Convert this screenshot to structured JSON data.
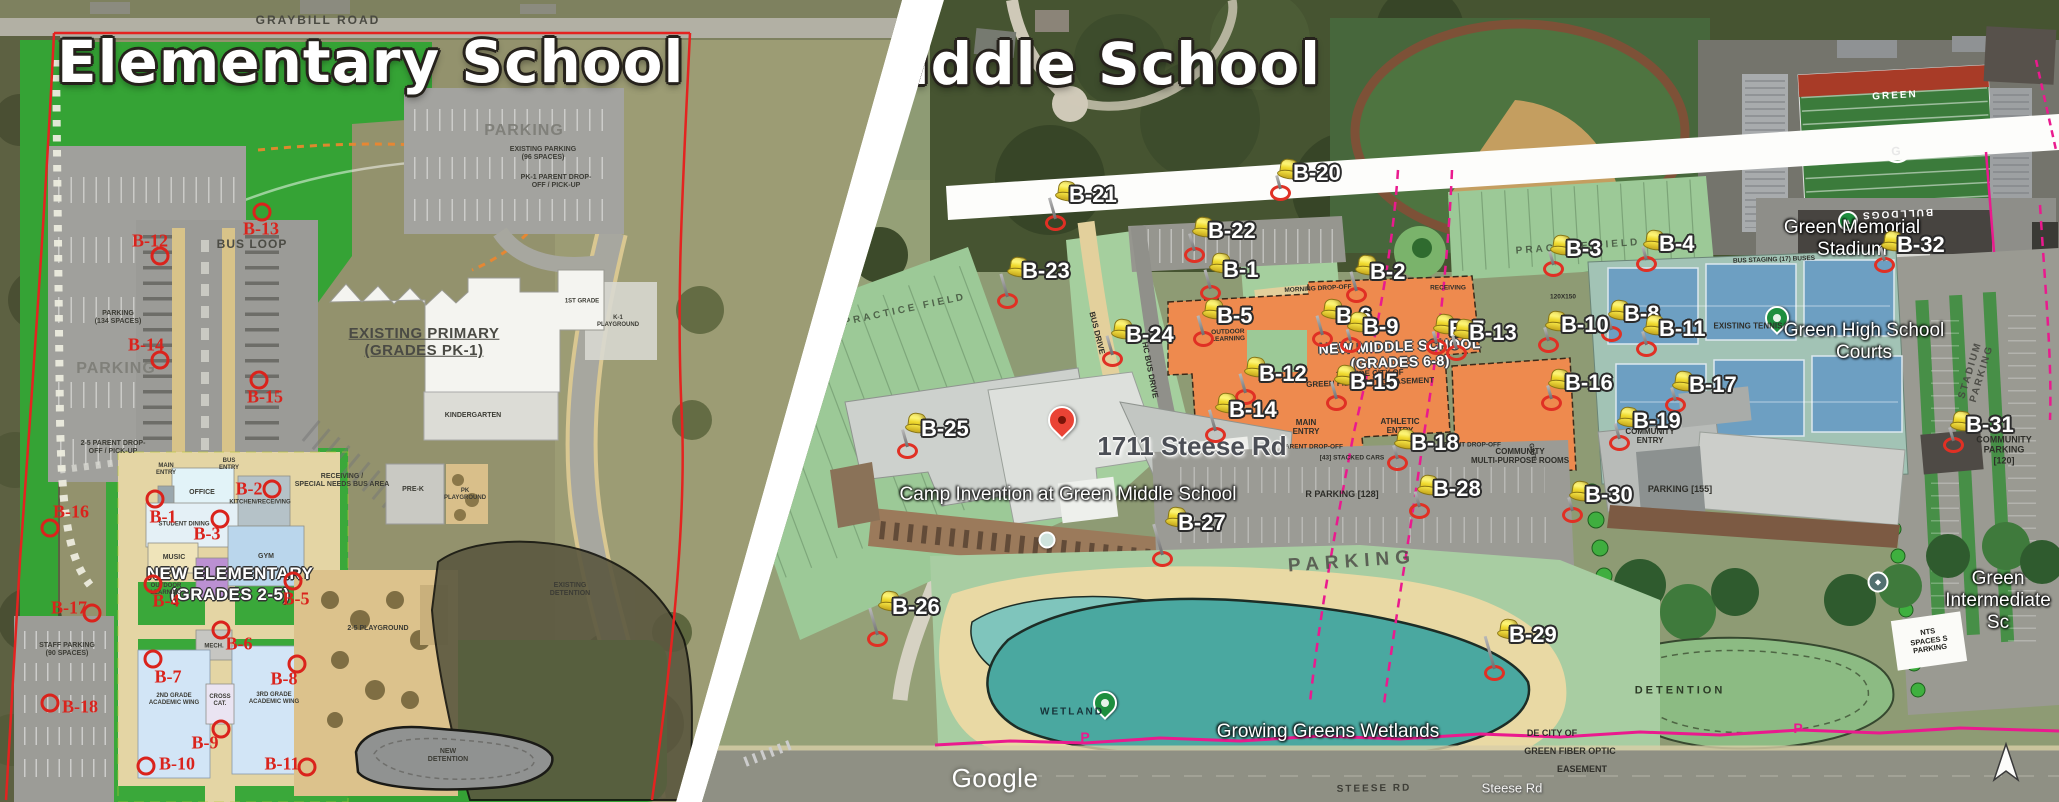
{
  "watermark": "Google",
  "left_panel": {
    "title": "Elementary School",
    "markers": [
      {
        "id": "B-1",
        "cx": 155,
        "cy": 499,
        "lx": 163,
        "ly": 517
      },
      {
        "id": "B-2",
        "cx": 272,
        "cy": 489,
        "lx": 249,
        "ly": 489
      },
      {
        "id": "B-3",
        "cx": 220,
        "cy": 519,
        "lx": 207,
        "ly": 534
      },
      {
        "id": "B-4",
        "cx": 153,
        "cy": 584,
        "lx": 166,
        "ly": 601
      },
      {
        "id": "B-5",
        "cx": 293,
        "cy": 581,
        "lx": 296,
        "ly": 599
      },
      {
        "id": "B-6",
        "cx": 221,
        "cy": 630,
        "lx": 239,
        "ly": 644
      },
      {
        "id": "B-7",
        "cx": 153,
        "cy": 659,
        "lx": 168,
        "ly": 677
      },
      {
        "id": "B-8",
        "cx": 297,
        "cy": 664,
        "lx": 284,
        "ly": 679
      },
      {
        "id": "B-9",
        "cx": 221,
        "cy": 729,
        "lx": 205,
        "ly": 743
      },
      {
        "id": "B-10",
        "cx": 146,
        "cy": 766,
        "lx": 177,
        "ly": 764
      },
      {
        "id": "B-11",
        "cx": 307,
        "cy": 767,
        "lx": 282,
        "ly": 764
      },
      {
        "id": "B-12",
        "cx": 160,
        "cy": 256,
        "lx": 150,
        "ly": 241
      },
      {
        "id": "B-13",
        "cx": 262,
        "cy": 212,
        "lx": 261,
        "ly": 229
      },
      {
        "id": "B-14",
        "cx": 160,
        "cy": 360,
        "lx": 146,
        "ly": 345
      },
      {
        "id": "B-15",
        "cx": 259,
        "cy": 380,
        "lx": 265,
        "ly": 397
      },
      {
        "id": "B-16",
        "cx": 50,
        "cy": 528,
        "lx": 71,
        "ly": 512
      },
      {
        "id": "B-17",
        "cx": 92,
        "cy": 613,
        "lx": 69,
        "ly": 608
      },
      {
        "id": "B-18",
        "cx": 50,
        "cy": 703,
        "lx": 80,
        "ly": 707
      }
    ],
    "labels": [
      {
        "t": "GRAYBILL ROAD",
        "x": 318,
        "y": 21,
        "cls": "l-road"
      },
      {
        "t": "PARKING",
        "x": 524,
        "y": 131,
        "cls": "l-big"
      },
      {
        "t": "EXISTING PARKING\n(96 SPACES)",
        "x": 543,
        "y": 154,
        "cls": "l-tiny"
      },
      {
        "t": "PK-1 PARENT DROP-\nOFF / PICK-UP",
        "x": 556,
        "y": 182,
        "cls": "l-tiny"
      },
      {
        "t": "BUS LOOP",
        "x": 252,
        "y": 245,
        "cls": "l-med"
      },
      {
        "t": "PARKING\n(134 SPACES)",
        "x": 118,
        "y": 318,
        "cls": "l-tiny"
      },
      {
        "t": "PARKING",
        "x": 116,
        "y": 369,
        "cls": "l-big"
      },
      {
        "t": "2-5 PARENT DROP-\nOFF / PICK-UP",
        "x": 113,
        "y": 448,
        "cls": "l-tiny"
      },
      {
        "t": "EXISTING PRIMARY\n(GRADES PK-1)",
        "x": 424,
        "y": 342,
        "cls": "l-title-u"
      },
      {
        "t": "KINDERGARTEN",
        "x": 473,
        "y": 416,
        "cls": "l-tiny"
      },
      {
        "t": "PRE-K",
        "x": 413,
        "y": 490,
        "cls": "l-tiny"
      },
      {
        "t": "PK\nPLAYGROUND",
        "x": 465,
        "y": 495,
        "cls": "l-micro"
      },
      {
        "t": "RECEIVING /\nSPECIAL NEEDS BUS AREA",
        "x": 342,
        "y": 481,
        "cls": "l-tiny"
      },
      {
        "t": "MAIN\nENTRY",
        "x": 166,
        "y": 470,
        "cls": "l-micro"
      },
      {
        "t": "BUS\nENTRY",
        "x": 229,
        "y": 465,
        "cls": "l-micro"
      },
      {
        "t": "OFFICE",
        "x": 202,
        "y": 493,
        "cls": "l-tiny"
      },
      {
        "t": "KITCHEN/RECEIVING",
        "x": 260,
        "y": 503,
        "cls": "l-micro"
      },
      {
        "t": "STUDENT DINING",
        "x": 184,
        "y": 525,
        "cls": "l-micro"
      },
      {
        "t": "MUSIC",
        "x": 174,
        "y": 558,
        "cls": "l-tiny"
      },
      {
        "t": "GYM",
        "x": 266,
        "y": 557,
        "cls": "l-tiny"
      },
      {
        "t": "NEW ELEMENTARY",
        "x": 230,
        "y": 574,
        "cls": "l-white-big"
      },
      {
        "t": "(GRADES 2-5)",
        "x": 230,
        "y": 595,
        "cls": "l-white-big"
      },
      {
        "t": "OUTDOOR\nLEARNING",
        "x": 166,
        "y": 590,
        "cls": "l-micro"
      },
      {
        "t": "MECH.",
        "x": 214,
        "y": 647,
        "cls": "l-micro"
      },
      {
        "t": "2ND GRADE\nACADEMIC WING",
        "x": 174,
        "y": 700,
        "cls": "l-micro"
      },
      {
        "t": "CROSS\nCAT.",
        "x": 220,
        "y": 701,
        "cls": "l-micro"
      },
      {
        "t": "3RD GRADE\nACADEMIC WING",
        "x": 274,
        "y": 699,
        "cls": "l-micro"
      },
      {
        "t": "2-5 PLAYGROUND",
        "x": 378,
        "y": 629,
        "cls": "l-tiny"
      },
      {
        "t": "EXISTING\nDETENTION",
        "x": 570,
        "y": 590,
        "cls": "l-tiny"
      },
      {
        "t": "NEW\nDETENTION",
        "x": 448,
        "y": 756,
        "cls": "l-tiny"
      },
      {
        "t": "STAFF PARKING\n(90 SPACES)",
        "x": 67,
        "y": 650,
        "cls": "l-tiny"
      },
      {
        "t": "K-1\nPLAYGROUND",
        "x": 618,
        "y": 322,
        "cls": "l-micro"
      },
      {
        "t": "1ST GRADE",
        "x": 582,
        "y": 302,
        "cls": "l-micro"
      }
    ]
  },
  "right_panel": {
    "title": "Middle School",
    "pins": [
      {
        "id": "B-1",
        "x": 1210,
        "y": 290,
        "n": 20,
        "lx": 1223,
        "ly": 257
      },
      {
        "id": "B-2",
        "x": 1356,
        "y": 292,
        "n": 20,
        "lx": 1370,
        "ly": 259
      },
      {
        "id": "B-3",
        "x": 1553,
        "y": 266,
        "n": 14,
        "lx": 1566,
        "ly": 236
      },
      {
        "id": "B-4",
        "x": 1646,
        "y": 261,
        "n": 14,
        "lx": 1659,
        "ly": 231
      },
      {
        "id": "B-5",
        "x": 1203,
        "y": 336,
        "n": 20,
        "lx": 1217,
        "ly": 303
      },
      {
        "id": "B-6",
        "x": 1322,
        "y": 336,
        "n": 20,
        "lx": 1336,
        "ly": 303
      },
      {
        "id": "B-7",
        "x": 1436,
        "y": 344,
        "n": 12,
        "lx": 1449,
        "ly": 316
      },
      {
        "id": "B-8",
        "x": 1611,
        "y": 331,
        "n": 14,
        "lx": 1624,
        "ly": 301
      },
      {
        "id": "B-9",
        "x": 1350,
        "y": 342,
        "n": 12,
        "lx": 1363,
        "ly": 314
      },
      {
        "id": "B-10",
        "x": 1548,
        "y": 342,
        "n": 14,
        "lx": 1561,
        "ly": 312
      },
      {
        "id": "B-11",
        "x": 1646,
        "y": 346,
        "n": 14,
        "lx": 1659,
        "ly": 316
      },
      {
        "id": "B-12",
        "x": 1245,
        "y": 394,
        "n": 20,
        "lx": 1259,
        "ly": 361
      },
      {
        "id": "B-13",
        "x": 1456,
        "y": 350,
        "n": 14,
        "lx": 1469,
        "ly": 320
      },
      {
        "id": "B-14",
        "x": 1215,
        "y": 432,
        "n": 22,
        "lx": 1229,
        "ly": 397
      },
      {
        "id": "B-15",
        "x": 1336,
        "y": 400,
        "n": 18,
        "lx": 1350,
        "ly": 369
      },
      {
        "id": "B-16",
        "x": 1551,
        "y": 400,
        "n": 14,
        "lx": 1565,
        "ly": 370
      },
      {
        "id": "B-17",
        "x": 1675,
        "y": 402,
        "n": 14,
        "lx": 1689,
        "ly": 372
      },
      {
        "id": "B-18",
        "x": 1397,
        "y": 460,
        "n": 14,
        "lx": 1411,
        "ly": 430
      },
      {
        "id": "B-19",
        "x": 1619,
        "y": 440,
        "n": 16,
        "lx": 1633,
        "ly": 408
      },
      {
        "id": "B-20",
        "x": 1280,
        "y": 190,
        "n": 14,
        "lx": 1293,
        "ly": 160
      },
      {
        "id": "B-21",
        "x": 1055,
        "y": 220,
        "n": 22,
        "lx": 1069,
        "ly": 182
      },
      {
        "id": "B-22",
        "x": 1194,
        "y": 252,
        "n": 18,
        "lx": 1208,
        "ly": 218
      },
      {
        "id": "B-23",
        "x": 1007,
        "y": 298,
        "n": 24,
        "lx": 1022,
        "ly": 258
      },
      {
        "id": "B-24",
        "x": 1112,
        "y": 356,
        "n": 20,
        "lx": 1126,
        "ly": 322
      },
      {
        "id": "B-25",
        "x": 907,
        "y": 448,
        "n": 18,
        "lx": 921,
        "ly": 416
      },
      {
        "id": "B-26",
        "x": 877,
        "y": 636,
        "n": 28,
        "lx": 892,
        "ly": 594
      },
      {
        "id": "B-27",
        "x": 1162,
        "y": 556,
        "n": 32,
        "lx": 1178,
        "ly": 510
      },
      {
        "id": "B-28",
        "x": 1419,
        "y": 508,
        "n": 16,
        "lx": 1433,
        "ly": 476
      },
      {
        "id": "B-29",
        "x": 1494,
        "y": 670,
        "n": 34,
        "lx": 1509,
        "ly": 622
      },
      {
        "id": "B-30",
        "x": 1572,
        "y": 512,
        "n": 14,
        "lx": 1585,
        "ly": 482
      },
      {
        "id": "B-31",
        "x": 1953,
        "y": 442,
        "n": 14,
        "lx": 1966,
        "ly": 412
      },
      {
        "id": "B-32",
        "x": 1884,
        "y": 262,
        "n": 14,
        "lx": 1897,
        "ly": 232
      }
    ],
    "labels": [
      {
        "t": "PRACTICE FIELD",
        "x": 905,
        "y": 310,
        "cls": "r-field",
        "rot": -12
      },
      {
        "t": "PRACTICE FIELD",
        "x": 1578,
        "y": 247,
        "cls": "r-field",
        "rot": -4
      },
      {
        "t": "BUS DRIVE",
        "x": 1097,
        "y": 333,
        "cls": "r-plan-sm",
        "rot": 76
      },
      {
        "t": "HC BUS DRIVE",
        "x": 1150,
        "y": 370,
        "cls": "r-plan-sm",
        "rot": 79
      },
      {
        "t": "MORNING DROP-OFF",
        "x": 1318,
        "y": 289,
        "cls": "r-plan-xs",
        "rot": -3
      },
      {
        "t": "RECEIVING",
        "x": 1448,
        "y": 288,
        "cls": "r-plan-xs"
      },
      {
        "t": "BUS STAGING (17) BUSES",
        "x": 1774,
        "y": 260,
        "cls": "r-plan-xs",
        "rot": -2
      },
      {
        "t": "120X150",
        "x": 1563,
        "y": 297,
        "cls": "r-plan-xs"
      },
      {
        "t": "NEW MIDDLE SCHOOL\n(GRADES 6-8)",
        "x": 1400,
        "y": 354,
        "cls": "r-white-md",
        "rot": -2
      },
      {
        "t": "20' WIDE CITY OF\nGREEN FIBER OPTIC EASEMENT",
        "x": 1370,
        "y": 378,
        "cls": "r-plan-sm",
        "rot": -2
      },
      {
        "t": "OUTDOOR\nLEARNING",
        "x": 1228,
        "y": 336,
        "cls": "r-plan-xs",
        "rot": -2
      },
      {
        "t": "MAIN\nENTRY",
        "x": 1306,
        "y": 427,
        "cls": "r-plan-sm"
      },
      {
        "t": "ATHLETIC\nENTRY",
        "x": 1400,
        "y": 426,
        "cls": "r-plan-sm"
      },
      {
        "t": "PARENT DROP-OFF",
        "x": 1312,
        "y": 447,
        "cls": "r-plan-xs"
      },
      {
        "t": "PARENT DROP-OFF",
        "x": 1470,
        "y": 445,
        "cls": "r-plan-xs"
      },
      {
        "t": "[43] STACKED CARS",
        "x": 1352,
        "y": 458,
        "cls": "r-plan-xs"
      },
      {
        "t": "R PARKING [128]",
        "x": 1342,
        "y": 494,
        "cls": "r-plan"
      },
      {
        "t": "PARKING",
        "x": 1352,
        "y": 562,
        "cls": "r-parking-big",
        "rot": -4
      },
      {
        "t": "GATE",
        "x": 1532,
        "y": 452,
        "cls": "r-plan-xs",
        "rot": 80
      },
      {
        "t": "COMMUNITY\nMULTI-PURPOSE ROOMS",
        "x": 1520,
        "y": 456,
        "cls": "r-plan-sm"
      },
      {
        "t": "COMMUNITY\nENTRY",
        "x": 1650,
        "y": 436,
        "cls": "r-plan-sm"
      },
      {
        "t": "COMMUNITY\nPARKING [120]",
        "x": 2004,
        "y": 450,
        "cls": "r-plan"
      },
      {
        "t": "PARKING [155]",
        "x": 1680,
        "y": 489,
        "cls": "r-plan"
      },
      {
        "t": "STADIUM PARKING",
        "x": 1976,
        "y": 372,
        "cls": "r-stadium-pk",
        "rot": -73
      },
      {
        "t": "DETENTION",
        "x": 1680,
        "y": 691,
        "cls": "r-detention"
      },
      {
        "t": "WETLAND",
        "x": 1072,
        "y": 712,
        "cls": "r-wetland"
      },
      {
        "t": "NTS\nSPACES S\nPARKING",
        "x": 1929,
        "y": 641,
        "cls": "r-patch",
        "rot": -8
      },
      {
        "t": "DE CITY OF",
        "x": 1552,
        "y": 733,
        "cls": "r-plan"
      },
      {
        "t": "GREEN FIBER OPTIC",
        "x": 1570,
        "y": 751,
        "cls": "r-plan"
      },
      {
        "t": "EASEMENT",
        "x": 1582,
        "y": 769,
        "cls": "r-plan"
      },
      {
        "t": "STEESE RD",
        "x": 1374,
        "y": 789,
        "cls": "r-steese",
        "rot": -1
      },
      {
        "t": "EXISTING TENNIS",
        "x": 1748,
        "y": 326,
        "cls": "r-plan-sm"
      },
      {
        "t": "GREEN",
        "x": 1895,
        "y": 96,
        "cls": "r-endzone",
        "rot": -3
      },
      {
        "t": "BULLDOGS",
        "x": 1897,
        "y": 213,
        "cls": "r-endzone",
        "rot": 177
      },
      {
        "t": "G",
        "x": 1896,
        "y": 152,
        "cls": "r-glogo",
        "rot": -3
      },
      {
        "t": "P",
        "x": 1085,
        "y": 737,
        "cls": "r-pink"
      },
      {
        "t": "P",
        "x": 1382,
        "y": 731,
        "cls": "r-pink"
      },
      {
        "t": "P",
        "x": 1798,
        "y": 728,
        "cls": "r-pink"
      },
      {
        "t": "Green Memorial Stadium",
        "x": 1852,
        "y": 239,
        "cls": "r-glabel"
      },
      {
        "t": "Green High School Courts",
        "x": 1864,
        "y": 342,
        "cls": "r-glabel"
      },
      {
        "t": "Growing Greens Wetlands",
        "x": 1328,
        "y": 732,
        "cls": "r-glabel"
      },
      {
        "t": "Green Intermediate Sc",
        "x": 1998,
        "y": 601,
        "cls": "r-glabel"
      },
      {
        "t": "Camp Invention at Green Middle School",
        "x": 1068,
        "y": 495,
        "cls": "r-glabel"
      },
      {
        "t": "1711 Steese Rd",
        "x": 1192,
        "y": 447,
        "cls": "r-address"
      },
      {
        "t": "Steese Rd",
        "x": 1512,
        "y": 789,
        "cls": "r-road-glabel"
      },
      {
        "t": "Google",
        "x": 995,
        "y": 779,
        "cls": "r-google"
      }
    ]
  }
}
